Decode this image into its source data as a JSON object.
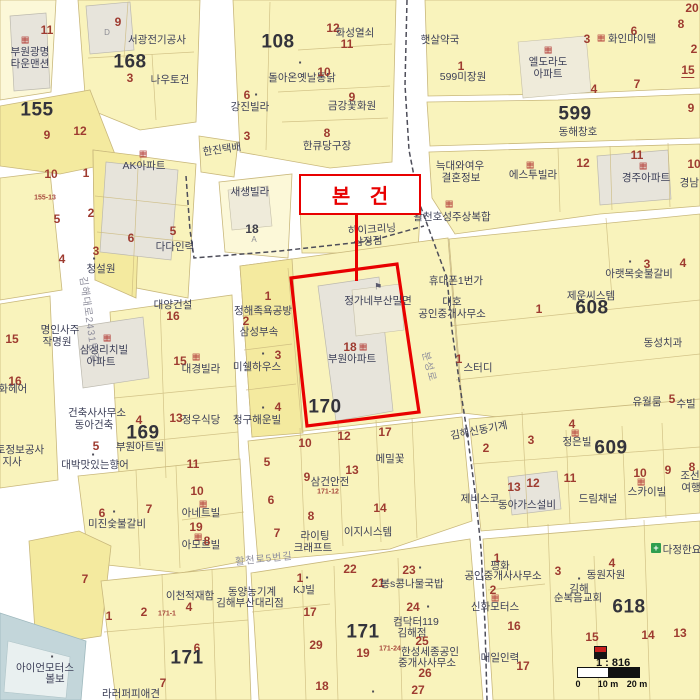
{
  "map": {
    "callout": {
      "label": "본 건"
    },
    "scale": {
      "ratio": "1 : 816",
      "ticks": [
        "0",
        "10 m",
        "20 m"
      ]
    },
    "colors": {
      "parcel_fill": "#F9F3BC",
      "parcel_alt": "#F4EA9F",
      "building_fill": "#E7E4DB",
      "water_fill": "#C3D6DA",
      "highlight_red": "#E80000",
      "boundary_line": "#4E4E5A",
      "lot_number": "#9E3B30",
      "parcel_number": "#33333B",
      "place_text": "#3E4159",
      "road_text": "#8E8E9C"
    },
    "labels": [
      [
        "9",
        118,
        22,
        "n"
      ],
      [
        "D",
        107,
        33,
        "g"
      ],
      [
        "서광전기공사",
        157,
        40,
        "p"
      ],
      [
        "11",
        47,
        30,
        "n"
      ],
      [
        "apt",
        25,
        40,
        "i"
      ],
      [
        "부원광명",
        30,
        52,
        "p"
      ],
      [
        "타운맨션",
        30,
        64,
        "p"
      ],
      [
        "168",
        130,
        62,
        "b"
      ],
      [
        "3",
        130,
        78,
        "n"
      ],
      [
        "나우토건",
        170,
        80,
        "p"
      ],
      [
        "155",
        37,
        110,
        "b"
      ],
      [
        "155-13",
        45,
        198,
        "t"
      ],
      [
        "9",
        47,
        135,
        "n"
      ],
      [
        "12",
        80,
        131,
        "n"
      ],
      [
        "108",
        278,
        42,
        "b"
      ],
      [
        "12",
        333,
        28,
        "n"
      ],
      [
        "화성열쇠",
        355,
        33,
        "p"
      ],
      [
        "11",
        347,
        44,
        "n"
      ],
      [
        "dark",
        300,
        63,
        "i"
      ],
      [
        "돌아온옛날통닭",
        302,
        78,
        "p"
      ],
      [
        "10",
        324,
        72,
        "n"
      ],
      [
        "9",
        352,
        97,
        "n"
      ],
      [
        "금강꽃화원",
        352,
        106,
        "p"
      ],
      [
        "8",
        327,
        133,
        "n"
      ],
      [
        "한큐당구장",
        327,
        146,
        "p"
      ],
      [
        "6",
        247,
        95,
        "n"
      ],
      [
        "dark",
        256,
        95,
        "i"
      ],
      [
        "강진빌라",
        250,
        107,
        "p"
      ],
      [
        "3",
        247,
        136,
        "n"
      ],
      [
        "햇살약국",
        440,
        40,
        "p"
      ],
      [
        "1",
        461,
        66,
        "n"
      ],
      [
        "599미장원",
        463,
        77,
        "p"
      ],
      [
        "20",
        692,
        8,
        "n"
      ],
      [
        "8",
        681,
        24,
        "n"
      ],
      [
        "2",
        694,
        49,
        "n"
      ],
      [
        "3",
        587,
        39,
        "n"
      ],
      [
        "6",
        634,
        31,
        "n"
      ],
      [
        "apt",
        601,
        38,
        "i"
      ],
      [
        "화인마이텔",
        632,
        39,
        "p"
      ],
      [
        "apt",
        548,
        50,
        "i"
      ],
      [
        "엘도라도",
        548,
        62,
        "p"
      ],
      [
        "아파트",
        548,
        74,
        "p"
      ],
      [
        "15",
        688,
        71,
        "u"
      ],
      [
        "4",
        594,
        89,
        "n"
      ],
      [
        "7",
        637,
        84,
        "n"
      ],
      [
        "9",
        691,
        108,
        "n"
      ],
      [
        "599",
        575,
        114,
        "b"
      ],
      [
        "동해창호",
        578,
        132,
        "p"
      ],
      [
        "12",
        583,
        163,
        "n"
      ],
      [
        "11",
        637,
        155,
        "n"
      ],
      [
        "apt",
        643,
        166,
        "i"
      ],
      [
        "경주아파트",
        646,
        178,
        "p"
      ],
      [
        "10",
        694,
        164,
        "n"
      ],
      [
        "경남빌라",
        699,
        183,
        "p"
      ],
      [
        "한진택배",
        222,
        150,
        "p",
        -8
      ],
      [
        "apt",
        143,
        154,
        "i"
      ],
      [
        "AK아파트",
        144,
        166,
        "p"
      ],
      [
        "10",
        51,
        174,
        "n"
      ],
      [
        "1",
        86,
        173,
        "n"
      ],
      [
        "5",
        57,
        219,
        "n"
      ],
      [
        "2",
        91,
        213,
        "n"
      ],
      [
        "4",
        62,
        259,
        "n"
      ],
      [
        "3",
        96,
        251,
        "n"
      ],
      [
        "dark",
        94,
        259,
        "i"
      ],
      [
        "청설원",
        101,
        269,
        "p"
      ],
      [
        "6",
        131,
        238,
        "n"
      ],
      [
        "5",
        173,
        231,
        "n"
      ],
      [
        "다다인력",
        175,
        247,
        "p"
      ],
      [
        "새생빌라",
        250,
        192,
        "p"
      ],
      [
        "18",
        252,
        229,
        "d"
      ],
      [
        "A",
        254,
        240,
        "g"
      ],
      [
        "김해대로2431번길",
        88,
        320,
        "r",
        82
      ],
      [
        "늑대와여우",
        460,
        166,
        "p"
      ],
      [
        "결혼정보",
        461,
        178,
        "p"
      ],
      [
        "apt",
        449,
        204,
        "i"
      ],
      [
        "활천호성주상복합",
        452,
        217,
        "p"
      ],
      [
        "하이크리닝",
        372,
        230,
        "p",
        -4
      ],
      [
        "삼정점",
        368,
        242,
        "p",
        -4
      ],
      [
        "휴대폰1번가",
        456,
        281,
        "p"
      ],
      [
        "대호",
        452,
        302,
        "p"
      ],
      [
        "공인중개사무소",
        452,
        314,
        "p"
      ],
      [
        "1",
        539,
        309,
        "n"
      ],
      [
        "flag",
        378,
        287,
        "i"
      ],
      [
        "정가네부산밀면",
        378,
        301,
        "p"
      ],
      [
        "1",
        268,
        296,
        "n"
      ],
      [
        "정해족욕공방",
        263,
        311,
        "p"
      ],
      [
        "2",
        246,
        321,
        "n"
      ],
      [
        "삼성부속",
        259,
        332,
        "p"
      ],
      [
        "3",
        278,
        355,
        "n"
      ],
      [
        "dark",
        263,
        354,
        "i"
      ],
      [
        "미쉘하우스",
        257,
        367,
        "p"
      ],
      [
        "4",
        278,
        407,
        "n"
      ],
      [
        "dark",
        263,
        408,
        "i"
      ],
      [
        "청구해운빌",
        257,
        420,
        "p"
      ],
      [
        "18",
        350,
        347,
        "n"
      ],
      [
        "apt",
        363,
        347,
        "i"
      ],
      [
        "부원아파트",
        352,
        359,
        "p"
      ],
      [
        "170",
        325,
        407,
        "b"
      ],
      [
        "분성로",
        428,
        367,
        "r",
        75
      ],
      [
        "1",
        459,
        359,
        "n"
      ],
      [
        "스터디",
        478,
        368,
        "p"
      ],
      [
        "apt",
        530,
        165,
        "i"
      ],
      [
        "에스투빌라",
        533,
        175,
        "p"
      ],
      [
        "3",
        647,
        264,
        "n"
      ],
      [
        "dark",
        630,
        262,
        "i"
      ],
      [
        "아랫목숯불갈비",
        639,
        274,
        "p"
      ],
      [
        "4",
        683,
        263,
        "n"
      ],
      [
        "제운씨스템",
        591,
        296,
        "p"
      ],
      [
        "608",
        592,
        308,
        "b"
      ],
      [
        "동성치과",
        663,
        343,
        "p"
      ],
      [
        "유월룸",
        647,
        402,
        "p"
      ],
      [
        "5",
        672,
        399,
        "n"
      ],
      [
        "수빌",
        686,
        404,
        "p"
      ],
      [
        "김해신동기계",
        479,
        431,
        "p",
        -11
      ],
      [
        "15",
        12,
        339,
        "n"
      ],
      [
        "16",
        15,
        381,
        "n"
      ],
      [
        "담화헤어",
        8,
        389,
        "p"
      ],
      [
        "토정보공사",
        20,
        450,
        "p"
      ],
      [
        "지사",
        12,
        462,
        "p"
      ],
      [
        "대양건설",
        173,
        305,
        "p"
      ],
      [
        "16",
        173,
        316,
        "n"
      ],
      [
        "명인사주",
        60,
        330,
        "p"
      ],
      [
        "작명원",
        57,
        342,
        "p"
      ],
      [
        "apt",
        107,
        338,
        "i"
      ],
      [
        "삼성리치빌",
        104,
        350,
        "p"
      ],
      [
        "아파트",
        101,
        362,
        "p"
      ],
      [
        "15",
        180,
        361,
        "n"
      ],
      [
        "apt",
        196,
        357,
        "i"
      ],
      [
        "대경빌라",
        201,
        369,
        "p"
      ],
      [
        "건축사사무소",
        97,
        413,
        "p"
      ],
      [
        "동아건축",
        94,
        425,
        "p"
      ],
      [
        "4",
        139,
        420,
        "n"
      ],
      [
        "169",
        143,
        433,
        "b"
      ],
      [
        "부원아트빌",
        140,
        447,
        "p"
      ],
      [
        "13",
        176,
        418,
        "n"
      ],
      [
        "정우식당",
        201,
        420,
        "p"
      ],
      [
        "5",
        96,
        446,
        "n"
      ],
      [
        "dark",
        93,
        455,
        "i"
      ],
      [
        "대박맛있는향어",
        95,
        465,
        "p"
      ],
      [
        "11",
        193,
        464,
        "n"
      ],
      [
        "5",
        267,
        462,
        "n"
      ],
      [
        "10",
        305,
        443,
        "n"
      ],
      [
        "12",
        344,
        436,
        "n"
      ],
      [
        "17",
        385,
        432,
        "n"
      ],
      [
        "메밀꽃",
        390,
        459,
        "p"
      ],
      [
        "9",
        307,
        477,
        "n"
      ],
      [
        "삼건안전",
        330,
        482,
        "p"
      ],
      [
        "171-12",
        328,
        492,
        "t"
      ],
      [
        "13",
        352,
        470,
        "n"
      ],
      [
        "6",
        271,
        500,
        "n"
      ],
      [
        "8",
        311,
        516,
        "n"
      ],
      [
        "14",
        380,
        508,
        "n"
      ],
      [
        "7",
        277,
        533,
        "n"
      ],
      [
        "라이팅",
        315,
        536,
        "p"
      ],
      [
        "크래프트",
        313,
        548,
        "p"
      ],
      [
        "이지시스템",
        368,
        532,
        "p"
      ],
      [
        "활천로5번길",
        264,
        560,
        "r",
        -6
      ],
      [
        "22",
        350,
        569,
        "n"
      ],
      [
        "21",
        378,
        583,
        "n"
      ],
      [
        "23",
        409,
        570,
        "n"
      ],
      [
        "dark",
        420,
        568,
        "i"
      ],
      [
        "봉s콩나물국밥",
        412,
        584,
        "p"
      ],
      [
        "1",
        300,
        578,
        "n"
      ],
      [
        "dark",
        307,
        578,
        "i"
      ],
      [
        "KJ빌",
        304,
        590,
        "p"
      ],
      [
        "동양농기계",
        252,
        592,
        "p"
      ],
      [
        "김해부산대리점",
        250,
        603,
        "p"
      ],
      [
        "17",
        310,
        612,
        "n"
      ],
      [
        "29",
        316,
        645,
        "n"
      ],
      [
        "171",
        363,
        632,
        "b"
      ],
      [
        "19",
        363,
        653,
        "n"
      ],
      [
        "18",
        322,
        686,
        "n"
      ],
      [
        "24",
        413,
        607,
        "n"
      ],
      [
        "dark",
        428,
        607,
        "i"
      ],
      [
        "컴닥터119",
        416,
        622,
        "p"
      ],
      [
        "김해점",
        412,
        633,
        "p"
      ],
      [
        "25",
        422,
        641,
        "n"
      ],
      [
        "171-24",
        390,
        649,
        "t"
      ],
      [
        "한성세종공인",
        430,
        652,
        "p"
      ],
      [
        "중개사사무소",
        427,
        663,
        "p"
      ],
      [
        "26",
        425,
        673,
        "n"
      ],
      [
        "27",
        418,
        690,
        "n"
      ],
      [
        "dark",
        373,
        692,
        "i"
      ],
      [
        "6",
        102,
        513,
        "n"
      ],
      [
        "dark",
        114,
        512,
        "i"
      ],
      [
        "미진숯불갈비",
        117,
        524,
        "p"
      ],
      [
        "7",
        149,
        509,
        "n"
      ],
      [
        "10",
        197,
        491,
        "n"
      ],
      [
        "apt",
        203,
        504,
        "i"
      ],
      [
        "아네트빌",
        201,
        513,
        "p"
      ],
      [
        "19",
        196,
        527,
        "n"
      ],
      [
        "apt",
        198,
        537,
        "i"
      ],
      [
        "아모르빌",
        201,
        545,
        "p"
      ],
      [
        "8",
        207,
        541,
        "n"
      ],
      [
        "7",
        85,
        579,
        "n"
      ],
      [
        "이천적재함",
        190,
        596,
        "p"
      ],
      [
        "4",
        189,
        607,
        "n"
      ],
      [
        "1",
        109,
        616,
        "n"
      ],
      [
        "2",
        144,
        612,
        "n"
      ],
      [
        "171-1",
        167,
        614,
        "t"
      ],
      [
        "6",
        197,
        648,
        "n"
      ],
      [
        "171",
        187,
        658,
        "b"
      ],
      [
        "7",
        163,
        683,
        "n"
      ],
      [
        "라러퍼피애견",
        131,
        694,
        "p"
      ],
      [
        "dark",
        52,
        657,
        "i"
      ],
      [
        "아이언모터스",
        45,
        668,
        "p"
      ],
      [
        "볼보",
        55,
        679,
        "p"
      ],
      [
        "2",
        486,
        448,
        "n"
      ],
      [
        "3",
        531,
        440,
        "n"
      ],
      [
        "4",
        572,
        424,
        "n"
      ],
      [
        "apt",
        575,
        433,
        "i"
      ],
      [
        "정은빌",
        577,
        442,
        "p"
      ],
      [
        "609",
        611,
        448,
        "b"
      ],
      [
        "12",
        533,
        483,
        "n"
      ],
      [
        "11",
        570,
        478,
        "n"
      ],
      [
        "10",
        640,
        473,
        "n"
      ],
      [
        "apt",
        641,
        482,
        "i"
      ],
      [
        "스카이빌",
        647,
        492,
        "p"
      ],
      [
        "9",
        668,
        470,
        "n"
      ],
      [
        "8",
        692,
        467,
        "n"
      ],
      [
        "조선",
        690,
        476,
        "p"
      ],
      [
        "여행",
        691,
        488,
        "p"
      ],
      [
        "드림채널",
        598,
        499,
        "p"
      ],
      [
        "13",
        514,
        487,
        "n"
      ],
      [
        "동아가스설비",
        527,
        505,
        "p"
      ],
      [
        "제비스코",
        480,
        499,
        "p"
      ],
      [
        "1",
        497,
        558,
        "n"
      ],
      [
        "평화",
        500,
        566,
        "p"
      ],
      [
        "공인중개사사무소",
        503,
        576,
        "p"
      ],
      [
        "2",
        493,
        590,
        "n"
      ],
      [
        "apt",
        495,
        598,
        "i"
      ],
      [
        "신화모터스",
        495,
        607,
        "p"
      ],
      [
        "3",
        558,
        571,
        "n"
      ],
      [
        "동원자원",
        606,
        575,
        "p"
      ],
      [
        "4",
        612,
        563,
        "n"
      ],
      [
        "dark",
        579,
        579,
        "i"
      ],
      [
        "김해",
        579,
        589,
        "p"
      ],
      [
        "순복음교회",
        578,
        598,
        "p"
      ],
      [
        "618",
        629,
        607,
        "b"
      ],
      [
        "16",
        514,
        626,
        "n"
      ],
      [
        "15",
        592,
        637,
        "n"
      ],
      [
        "14",
        648,
        635,
        "n"
      ],
      [
        "13",
        680,
        633,
        "n"
      ],
      [
        "매일인력",
        500,
        658,
        "p"
      ],
      [
        "17",
        523,
        666,
        "n"
      ],
      [
        "cross",
        656,
        548,
        "i"
      ],
      [
        "다정한요",
        682,
        550,
        "p"
      ]
    ]
  }
}
